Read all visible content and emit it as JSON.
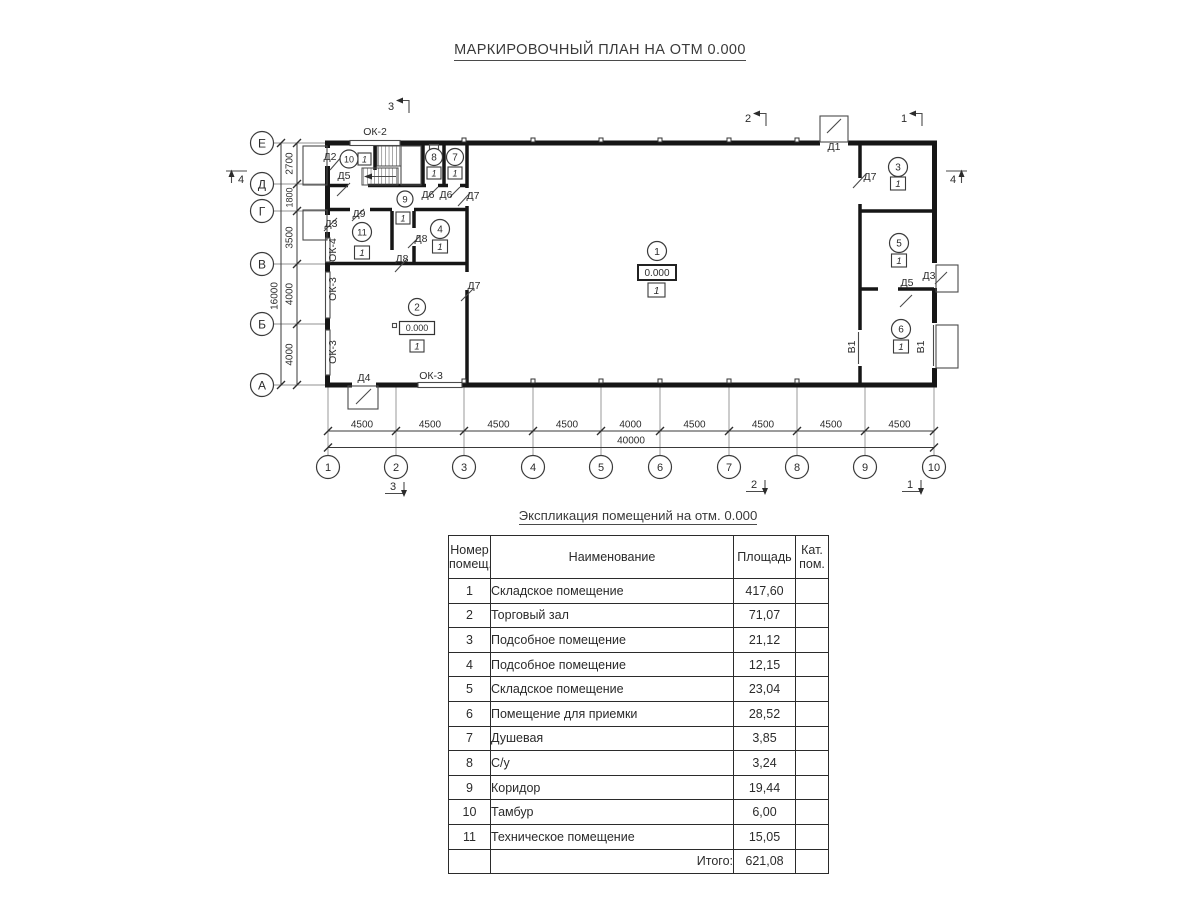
{
  "titles": {
    "plan": "МАРКИРОВОЧНЫЙ ПЛАН НА ОТМ 0.000",
    "table": "Экспликация помещений на отм. 0.000"
  },
  "plan": {
    "axis_cols": [
      "1",
      "2",
      "3",
      "4",
      "5",
      "6",
      "7",
      "8",
      "9",
      "10"
    ],
    "axis_rows": [
      "Е",
      "Д",
      "Г",
      "В",
      "Б",
      "А"
    ],
    "dims_bottom": [
      "4500",
      "4500",
      "4500",
      "4500",
      "4000",
      "4500",
      "4500",
      "4500",
      "4500"
    ],
    "dim_bottom_total": "40000",
    "dims_left": [
      "2700",
      "1800",
      "3500",
      "4000",
      "4000"
    ],
    "dim_left_total": "16000",
    "elevation": "0.000",
    "category": "1",
    "sections": {
      "s1": "1",
      "s2": "2",
      "s3": "3",
      "s4": "4"
    },
    "rooms": {
      "r1": "1",
      "r2": "2",
      "r3": "3",
      "r4": "4",
      "r5": "5",
      "r6": "6",
      "r7": "7",
      "r8": "8",
      "r9": "9",
      "r10": "10",
      "r11": "11"
    },
    "labels": {
      "ok2": "ОК-2",
      "ok3": "ОК-3",
      "ok4": "ОК-4",
      "d1": "Д1",
      "d2": "Д2",
      "d3": "Д3",
      "d4": "Д4",
      "d5": "Д5",
      "d6": "Д6",
      "d7": "Д7",
      "d8": "Д8",
      "d9": "Д9",
      "v1": "В1"
    }
  },
  "table": {
    "headers": [
      "Номер помещ.",
      "Наименование",
      "Площадь",
      "Кат. пом."
    ],
    "rows": [
      [
        "1",
        "Складское помещение",
        "417,60"
      ],
      [
        "2",
        "Торговый зал",
        "71,07"
      ],
      [
        "3",
        "Подсобное помещение",
        "21,12"
      ],
      [
        "4",
        "Подсобное помещение",
        "12,15"
      ],
      [
        "5",
        "Складское помещение",
        "23,04"
      ],
      [
        "6",
        "Помещение для приемки",
        "28,52"
      ],
      [
        "7",
        "Душевая",
        "3,85"
      ],
      [
        "8",
        "С/у",
        "3,24"
      ],
      [
        "9",
        "Коридор",
        "19,44"
      ],
      [
        "10",
        "Тамбур",
        "6,00"
      ],
      [
        "11",
        "Техническое помещение",
        "15,05"
      ]
    ],
    "total_label": "Итого:",
    "total_value": "621,08"
  }
}
